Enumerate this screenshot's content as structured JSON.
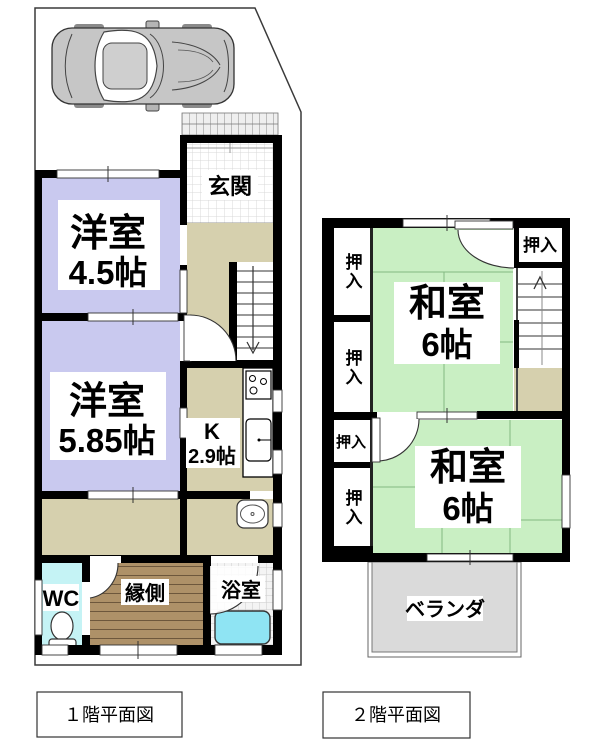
{
  "floor1": {
    "caption": "１階平面図",
    "rooms": {
      "genkan": {
        "label": "玄関"
      },
      "western1": {
        "label": "洋室",
        "size": "4.5帖"
      },
      "western2": {
        "label": "洋室",
        "size": "5.85帖"
      },
      "kitchen": {
        "label": "K",
        "size": "2.9帖"
      },
      "wc": {
        "label": "WC"
      },
      "engawa": {
        "label": "縁側"
      },
      "bathroom": {
        "label": "浴室"
      }
    }
  },
  "floor2": {
    "caption": "２階平面図",
    "rooms": {
      "japanese1": {
        "label": "和室",
        "size": "6帖"
      },
      "japanese2": {
        "label": "和室",
        "size": "6帖"
      },
      "closet": {
        "label": "押入"
      },
      "veranda": {
        "label": "ベランダ"
      }
    }
  },
  "colors": {
    "western_room": "#c9c9ef",
    "tatami_room": "#c9efc3",
    "hallway": "#d6d0ae",
    "wc_floor": "#c5f3f5",
    "bathtub": "#8fe4f3",
    "engawa_wood": "#ae9168",
    "balcony": "#dadada",
    "wall": "#000000"
  }
}
